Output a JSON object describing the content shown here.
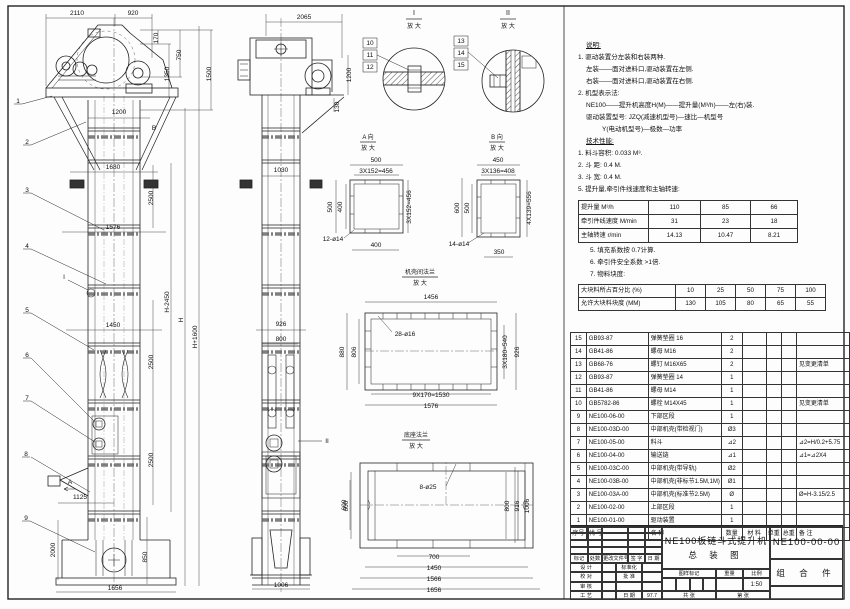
{
  "drawing": {
    "title_line1": "NE100板链斗式提升机",
    "title_line2": "总 装 图",
    "drawing_no": "NE100-00-00",
    "part_type": "组 合 件",
    "scale": "1:50",
    "date": "97.7"
  },
  "notes": {
    "lines": [
      {
        "t": "说明:",
        "ind": 1,
        "u": 1
      },
      {
        "t": "1. 驱动装置分左装和右装两种.",
        "ind": 0
      },
      {
        "t": "左装——面对进料口,驱动装置在左侧.",
        "ind": 1
      },
      {
        "t": "右装——面对进料口,驱动装置在右侧.",
        "ind": 1
      },
      {
        "t": "2. 机型表示法:",
        "ind": 0
      },
      {
        "t": "NE100——提升机高度H(M)——提升量(M³/h)——左(右)装.",
        "ind": 1
      },
      {
        "t": "驱动装置型号: JZQ(减速机型号)—速比—机型号",
        "ind": 1
      },
      {
        "t": "Y(电动机型号)—极数—功率",
        "ind": 3
      },
      {
        "t": "技术性能:",
        "ind": 1,
        "u": 1
      },
      {
        "t": "1. 料斗容积: 0.033 M³.",
        "ind": 0
      },
      {
        "t": "2. 斗  距: 0.4 M.",
        "ind": 0
      },
      {
        "t": "3. 斗  宽: 0.4 M.",
        "ind": 0
      },
      {
        "t": "5. 提升量,牵引件线速度和主轴转速:",
        "ind": 0
      }
    ],
    "lines2": [
      {
        "t": "5. 填充系数按 0.7计算.",
        "ind": 0
      },
      {
        "t": "6. 牵引件安全系数 >1倍.",
        "ind": 0
      },
      {
        "t": "7. 物料块度:",
        "ind": 0
      }
    ]
  },
  "performance_table": {
    "rows": [
      [
        "提升量 M³/h",
        "110",
        "85",
        "66"
      ],
      [
        "牵引件线速度 M/min",
        "31",
        "23",
        "18"
      ],
      [
        "主轴转速 r/min",
        "14.13",
        "10.47",
        "8.21"
      ]
    ]
  },
  "lump_table": {
    "rows": [
      [
        "大块料所占百分比 (%)",
        "10",
        "25",
        "50",
        "75",
        "100"
      ],
      [
        "允许大块料块度 (MM)",
        "130",
        "105",
        "80",
        "65",
        "55"
      ]
    ]
  },
  "bom": {
    "header": [
      "序号",
      "代  号",
      "名  称",
      "数量",
      "材 料",
      "单重",
      "总重",
      "备 注"
    ],
    "rows": [
      [
        "15",
        "GB93-87",
        "弹簧垫圈 16",
        "2",
        "",
        "",
        "",
        ""
      ],
      [
        "14",
        "GB41-86",
        "螺母 M16",
        "2",
        "",
        "",
        "",
        ""
      ],
      [
        "13",
        "GB68-76",
        "螺钉 M16X65",
        "2",
        "",
        "",
        "",
        "见变更清单"
      ],
      [
        "12",
        "GB93-87",
        "弹簧垫圈 14",
        "1",
        "",
        "",
        "",
        ""
      ],
      [
        "11",
        "GB41-86",
        "螺母 M14",
        "1",
        "",
        "",
        "",
        ""
      ],
      [
        "10",
        "GB5782-86",
        "螺栓 M14X45",
        "1",
        "",
        "",
        "",
        "见变更清单"
      ],
      [
        "9",
        "NE100-06-00",
        "下部区段",
        "1",
        "",
        "",
        "",
        ""
      ],
      [
        "8",
        "NE100-03D-00",
        "中部机壳(带检视门)",
        "Ø3",
        "",
        "",
        "",
        ""
      ],
      [
        "7",
        "NE100-05-00",
        "料斗",
        "⊿2",
        "",
        "",
        "",
        "⊿2=H/0.2+5.75"
      ],
      [
        "6",
        "NE100-04-00",
        "输送链",
        "⊿1",
        "",
        "",
        "",
        "⊿1=⊿2X4"
      ],
      [
        "5",
        "NE100-03C-00",
        "中部机壳(带导轨)",
        "Ø2",
        "",
        "",
        "",
        ""
      ],
      [
        "4",
        "NE100-03B-00",
        "中部机壳(非标节1.5M,1M)",
        "Ø1",
        "",
        "",
        "",
        ""
      ],
      [
        "3",
        "NE100-03A-00",
        "中部机壳(标准节2.5M)",
        "Ø",
        "",
        "",
        "",
        "Ø=H-3.15/2.5"
      ],
      [
        "2",
        "NE100-02-00",
        "上部区段",
        "1",
        "",
        "",
        "",
        ""
      ],
      [
        "1",
        "NE100-01-00",
        "驱动装置",
        "1",
        "",
        "",
        "",
        ""
      ]
    ]
  },
  "title_block": {
    "rev_header": [
      "标记",
      "处数",
      "更改文件号",
      "签 字",
      "日 期"
    ],
    "rows": [
      [
        "设 计",
        "",
        "标准化",
        ""
      ],
      [
        "校 对",
        "",
        "批 准",
        ""
      ],
      [
        "审 核",
        "",
        "",
        ""
      ],
      [
        "工 艺",
        "",
        "日 期",
        "97.7"
      ]
    ],
    "stamp_header": [
      "图样标记",
      "重量",
      "比例"
    ],
    "sheet_left": "共  张",
    "sheet_right": "第  张"
  },
  "labels": [
    {
      "t": "2110",
      "x": 77,
      "y": 15
    },
    {
      "t": "920",
      "x": 133,
      "y": 15
    },
    {
      "t": "170",
      "x": 158,
      "y": 38,
      "r": 1
    },
    {
      "t": "750",
      "x": 181,
      "y": 55,
      "r": 1
    },
    {
      "t": "1350",
      "x": 169,
      "y": 74,
      "r": 1
    },
    {
      "t": "1500",
      "x": 211,
      "y": 74,
      "r": 1
    },
    {
      "t": "1200",
      "x": 119,
      "y": 114
    },
    {
      "t": "B",
      "x": 154,
      "y": 130
    },
    {
      "t": "1680",
      "x": 113,
      "y": 169
    },
    {
      "t": "1576",
      "x": 113,
      "y": 229
    },
    {
      "t": "1450",
      "x": 113,
      "y": 327
    },
    {
      "t": "2500",
      "x": 153,
      "y": 198,
      "r": 1
    },
    {
      "t": "2500",
      "x": 153,
      "y": 362,
      "r": 1
    },
    {
      "t": "2500",
      "x": 153,
      "y": 460,
      "r": 1
    },
    {
      "t": "H-2450",
      "x": 169,
      "y": 302,
      "r": 1
    },
    {
      "t": "H",
      "x": 183,
      "y": 320,
      "r": 1
    },
    {
      "t": "H+1600",
      "x": 197,
      "y": 337,
      "r": 1
    },
    {
      "t": "1125",
      "x": 80,
      "y": 499
    },
    {
      "t": "2000",
      "x": 55,
      "y": 550,
      "r": 1
    },
    {
      "t": "850",
      "x": 147,
      "y": 557,
      "r": 1
    },
    {
      "t": "1656",
      "x": 115,
      "y": 590
    },
    {
      "t": "A",
      "x": 70,
      "y": 484
    },
    {
      "t": "I",
      "x": 64,
      "y": 279
    },
    {
      "t": "1",
      "x": 18,
      "y": 103,
      "n": "balloon-1"
    },
    {
      "t": "2",
      "x": 27,
      "y": 144,
      "n": "balloon-2"
    },
    {
      "t": "3",
      "x": 27,
      "y": 192,
      "n": "balloon-3"
    },
    {
      "t": "4",
      "x": 27,
      "y": 248,
      "n": "balloon-4"
    },
    {
      "t": "5",
      "x": 27,
      "y": 312,
      "n": "balloon-5"
    },
    {
      "t": "6",
      "x": 27,
      "y": 357,
      "n": "balloon-6"
    },
    {
      "t": "7",
      "x": 27,
      "y": 400,
      "n": "balloon-7"
    },
    {
      "t": "8",
      "x": 26,
      "y": 456,
      "n": "balloon-8"
    },
    {
      "t": "9",
      "x": 26,
      "y": 520,
      "n": "balloon-9"
    },
    {
      "t": "2065",
      "x": 304,
      "y": 19
    },
    {
      "t": "1200",
      "x": 351,
      "y": 75,
      "r": 1
    },
    {
      "t": "130",
      "x": 339,
      "y": 107,
      "r": 1
    },
    {
      "t": "1030",
      "x": 281,
      "y": 172
    },
    {
      "t": "926",
      "x": 281,
      "y": 326
    },
    {
      "t": "800",
      "x": 281,
      "y": 341
    },
    {
      "t": "600",
      "x": 346,
      "y": 505,
      "r": 1
    },
    {
      "t": "1006",
      "x": 281,
      "y": 587
    },
    {
      "t": "II",
      "x": 327,
      "y": 443
    },
    {
      "t": "I",
      "x": 414,
      "y": 15,
      "s": 7
    },
    {
      "t": "放 大",
      "x": 414,
      "y": 28,
      "s": 6
    },
    {
      "t": "10",
      "x": 370,
      "y": 45
    },
    {
      "t": "11",
      "x": 370,
      "y": 57
    },
    {
      "t": "12",
      "x": 370,
      "y": 69
    },
    {
      "t": "II",
      "x": 508,
      "y": 15,
      "s": 7
    },
    {
      "t": "放 大",
      "x": 508,
      "y": 28,
      "s": 6
    },
    {
      "t": "13",
      "x": 461,
      "y": 43
    },
    {
      "t": "14",
      "x": 461,
      "y": 55
    },
    {
      "t": "15",
      "x": 461,
      "y": 67
    },
    {
      "t": "A 向",
      "x": 368,
      "y": 139,
      "s": 6
    },
    {
      "t": "放 大",
      "x": 368,
      "y": 150,
      "s": 6
    },
    {
      "t": "500",
      "x": 376,
      "y": 162
    },
    {
      "t": "3X152=456",
      "x": 376,
      "y": 173
    },
    {
      "t": "500",
      "x": 332,
      "y": 207,
      "r": 1
    },
    {
      "t": "400",
      "x": 342,
      "y": 207,
      "r": 1
    },
    {
      "t": "3X152=456",
      "x": 411,
      "y": 207,
      "r": 1
    },
    {
      "t": "12-ø14",
      "x": 333,
      "y": 241
    },
    {
      "t": "400",
      "x": 376,
      "y": 247
    },
    {
      "t": "B 向",
      "x": 497,
      "y": 139,
      "s": 6
    },
    {
      "t": "放 大",
      "x": 497,
      "y": 150,
      "s": 6
    },
    {
      "t": "450",
      "x": 498,
      "y": 162
    },
    {
      "t": "3X136=408",
      "x": 498,
      "y": 173
    },
    {
      "t": "600",
      "x": 459,
      "y": 208,
      "r": 1
    },
    {
      "t": "500",
      "x": 469,
      "y": 208,
      "r": 1
    },
    {
      "t": "4X139=556",
      "x": 531,
      "y": 208,
      "r": 1
    },
    {
      "t": "14-ø14",
      "x": 459,
      "y": 246
    },
    {
      "t": "350",
      "x": 499,
      "y": 254
    },
    {
      "t": "机壳间法兰",
      "x": 420,
      "y": 274,
      "s": 6
    },
    {
      "t": "放 大",
      "x": 420,
      "y": 285,
      "s": 6
    },
    {
      "t": "1456",
      "x": 431,
      "y": 299
    },
    {
      "t": "28-ø16",
      "x": 405,
      "y": 336
    },
    {
      "t": "880",
      "x": 344,
      "y": 352,
      "r": 1
    },
    {
      "t": "806",
      "x": 356,
      "y": 352,
      "r": 1
    },
    {
      "t": "3X180=540",
      "x": 507,
      "y": 352,
      "r": 1
    },
    {
      "t": "926",
      "x": 519,
      "y": 352,
      "r": 1
    },
    {
      "t": "9X170=1530",
      "x": 431,
      "y": 397
    },
    {
      "t": "1576",
      "x": 431,
      "y": 408
    },
    {
      "t": "底座法兰",
      "x": 416,
      "y": 437,
      "s": 6
    },
    {
      "t": "放 大",
      "x": 416,
      "y": 448,
      "s": 6
    },
    {
      "t": "8-ø25",
      "x": 428,
      "y": 489
    },
    {
      "t": "600",
      "x": 348,
      "y": 506,
      "r": 1
    },
    {
      "t": "800",
      "x": 509,
      "y": 506,
      "r": 1
    },
    {
      "t": "916",
      "x": 519,
      "y": 506,
      "r": 1
    },
    {
      "t": "1006",
      "x": 529,
      "y": 506,
      "r": 1
    },
    {
      "t": "700",
      "x": 434,
      "y": 559
    },
    {
      "t": "1450",
      "x": 434,
      "y": 570
    },
    {
      "t": "1566",
      "x": 434,
      "y": 581
    },
    {
      "t": "1656",
      "x": 434,
      "y": 592
    }
  ]
}
